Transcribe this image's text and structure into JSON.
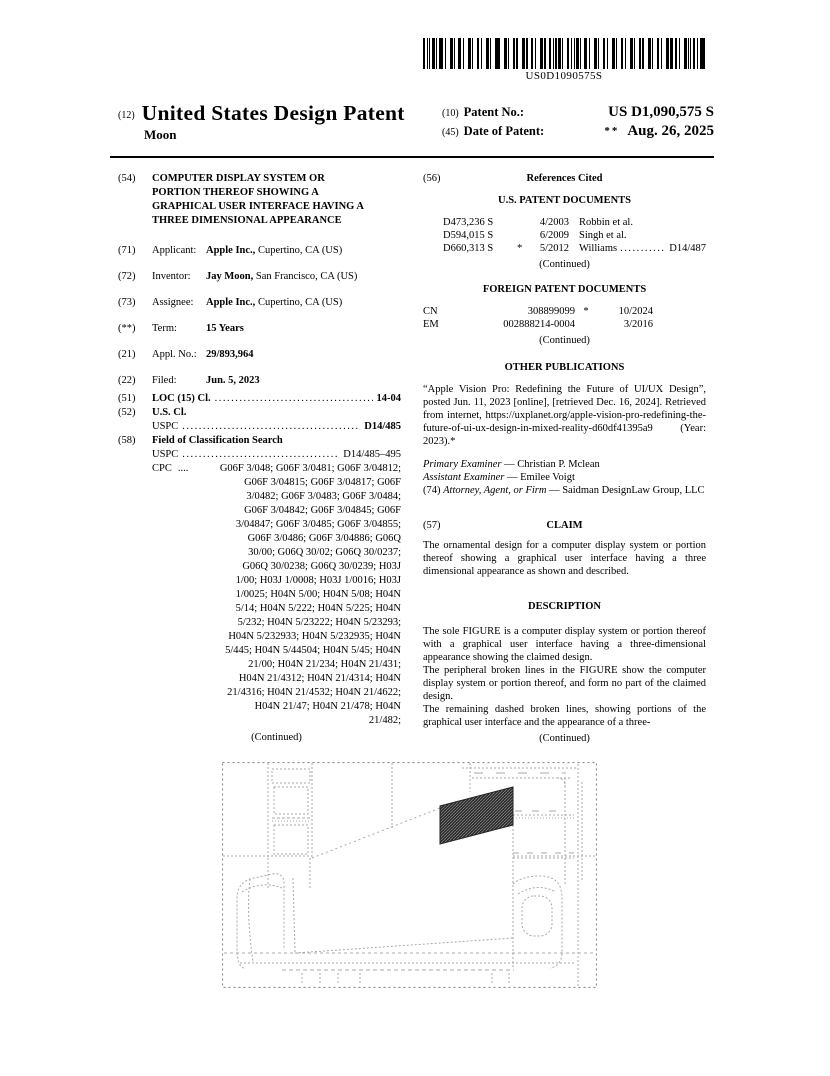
{
  "colors": {
    "line_gray": "#9b9b9b",
    "border_gray": "#8a8a8a",
    "panel_fill": "#2b2b2b"
  },
  "barcode": {
    "text": "US0D1090575S"
  },
  "header": {
    "kind_code_label": "(12)",
    "title": "United States Design Patent",
    "inventor_surname": "Moon",
    "patent_no_label_num": "(10)",
    "patent_no_label": "Patent No.:",
    "patent_no": "US D1,090,575 S",
    "date_label_num": "(45)",
    "date_label": "Date of Patent:",
    "date_prefix": "**",
    "date": "Aug. 26, 2025"
  },
  "biblio": {
    "f54": {
      "num": "(54)",
      "title_lines": [
        "COMPUTER DISPLAY SYSTEM OR",
        "PORTION THEREOF SHOWING A",
        "GRAPHICAL USER INTERFACE HAVING A",
        "THREE DIMENSIONAL APPEARANCE"
      ]
    },
    "f71": {
      "num": "(71)",
      "label": "Applicant:",
      "bold": "Apple Inc.,",
      "rest": " Cupertino, CA (US)"
    },
    "f72": {
      "num": "(72)",
      "label": "Inventor:",
      "bold": "Jay Moon,",
      "rest": " San Francisco, CA (US)"
    },
    "f73": {
      "num": "(73)",
      "label": "Assignee:",
      "bold": "Apple Inc.,",
      "rest": " Cupertino, CA (US)"
    },
    "fterm": {
      "num": "(**)",
      "label": "Term:",
      "bold": "15 Years",
      "rest": ""
    },
    "f21": {
      "num": "(21)",
      "label": "Appl. No.:",
      "bold": "29/893,964",
      "rest": ""
    },
    "f22": {
      "num": "(22)",
      "label": "Filed:",
      "bold": "Jun. 5, 2023",
      "rest": ""
    },
    "f51": {
      "num": "(51)",
      "label": "LOC (15) Cl.",
      "dots": "......................................................................",
      "value": "14-04"
    },
    "f52": {
      "num": "(52)",
      "heading": "U.S. Cl.",
      "uspc_label": "USPC",
      "dots": "......................................................................",
      "value": "D14/485"
    },
    "f58": {
      "num": "(58)",
      "heading": "Field of Classification Search",
      "uspc_label": "USPC",
      "uspc_dots": "......................................................................",
      "uspc_value": "D14/485–495",
      "cpc_label": "CPC",
      "cpc_dots": "....",
      "cpc_lines": [
        "G06F 3/048; G06F 3/0481; G06F 3/04812;",
        "G06F 3/04815; G06F 3/04817; G06F",
        "3/0482; G06F 3/0483; G06F 3/0484;",
        "G06F 3/04842; G06F 3/04845; G06F",
        "3/04847; G06F 3/0485; G06F 3/04855;",
        "G06F 3/0486; G06F 3/04886; G06Q",
        "30/00; G06Q 30/02; G06Q 30/0237;",
        "G06Q 30/0238; G06Q 30/0239; H03J",
        "1/00; H03J 1/0008; H03J 1/0016; H03J",
        "1/0025; H04N 5/00; H04N 5/08; H04N",
        "5/14; H04N 5/222; H04N 5/225; H04N",
        "5/232; H04N 5/23222; H04N 5/23293;",
        "H04N 5/232933; H04N 5/232935; H04N",
        "5/445; H04N 5/44504; H04N 5/45; H04N",
        "21/00; H04N 21/234; H04N 21/431;",
        "H04N 21/4312; H04N 21/4314; H04N",
        "21/4316; H04N 21/4532; H04N 21/4622;",
        "H04N 21/47; H04N 21/478; H04N",
        "21/482;"
      ],
      "continued": "(Continued)"
    }
  },
  "refs": {
    "num": "(56)",
    "heading": "References Cited",
    "us_heading": "U.S. PATENT DOCUMENTS",
    "us_rows": [
      {
        "no": "D473,236 S",
        "star": "",
        "date": "4/2003",
        "name": "Robbin et al.",
        "leader": "",
        "cls": ""
      },
      {
        "no": "D594,015 S",
        "star": "",
        "date": "6/2009",
        "name": "Singh et al.",
        "leader": "",
        "cls": ""
      },
      {
        "no": "D660,313 S",
        "star": "*",
        "date": "5/2012",
        "name": "Williams",
        "leader": "....................",
        "cls": "D14/487"
      }
    ],
    "us_continued": "(Continued)",
    "foreign_heading": "FOREIGN PATENT DOCUMENTS",
    "foreign_rows": [
      {
        "country": "CN",
        "no": "308899099",
        "star": "*",
        "date": "10/2024"
      },
      {
        "country": "EM",
        "no": "002888214-0004",
        "star": "",
        "date": "3/2016"
      }
    ],
    "foreign_continued": "(Continued)"
  },
  "other_pubs": {
    "heading": "OTHER PUBLICATIONS",
    "body": "“Apple Vision Pro: Redefining the Future of UI/UX Design”, posted Jun. 11, 2023 [online], [retrieved Dec. 16, 2024]. Retrieved from internet, https://uxplanet.org/apple-vision-pro-redefining-the-future-of-ui-ux-design-in-mixed-reality-d60df41395a9 (Year: 2023).*"
  },
  "examiners": {
    "primary_label": "Primary Examiner",
    "primary": " — Christian P. Mclean",
    "assistant_label": "Assistant Examiner",
    "assistant": " — Emilee Voigt",
    "firm_num": "(74) ",
    "firm_label": "Attorney, Agent, or Firm",
    "firm": " — Saidman DesignLaw Group, LLC"
  },
  "claim": {
    "num": "(57)",
    "heading": "CLAIM",
    "body": "The ornamental design for a computer display system or portion thereof showing a graphical user interface having a three dimensional appearance as shown and described."
  },
  "description": {
    "heading": "DESCRIPTION",
    "p1": "The sole FIGURE is a computer display system or portion thereof with a graphical user interface having a three-dimensional appearance showing the claimed design.",
    "p2": "The peripheral broken lines in the FIGURE show the computer display system or portion thereof, and form no part of the claimed design.",
    "p3": "The remaining dashed broken lines, showing portions of the graphical user interface and the appearance of a three-",
    "continued": "(Continued)"
  }
}
